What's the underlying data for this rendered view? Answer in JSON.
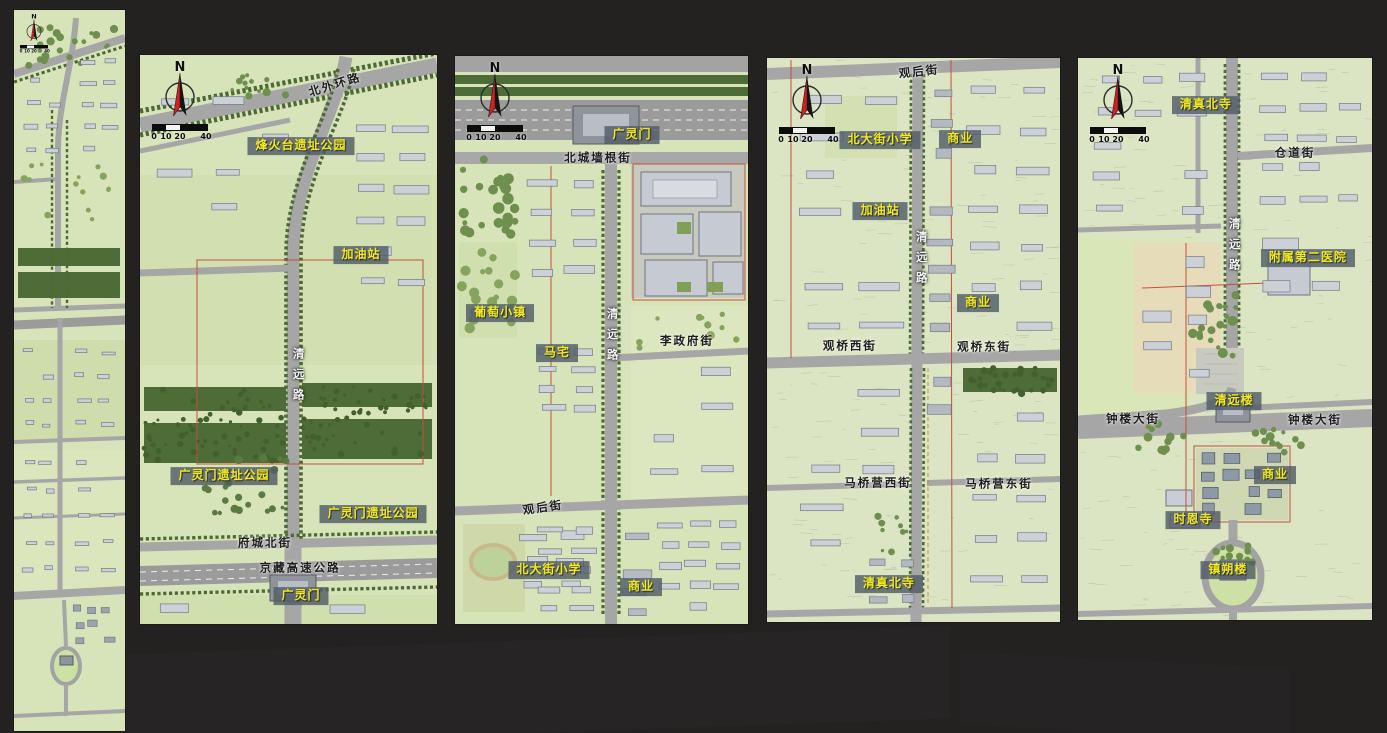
{
  "shared": {
    "compass_letter": "N",
    "scalebar_ticks": [
      "0",
      "10",
      "20",
      "40"
    ],
    "colors": {
      "place_text": "#f2ea1c",
      "place_box": "rgba(82,93,104,0.82)",
      "map_green": "#d7e3b8",
      "road_gray": "#a6a6a6",
      "tree_green": "#4d6c38",
      "backdrop": "#232221"
    }
  },
  "panels": [
    {
      "id": "overview",
      "labels": []
    },
    {
      "id": "section-1",
      "labels": [
        {
          "text": "北外环路",
          "kind": "street-dark",
          "x": 65.7,
          "y": 5.3,
          "rot": -17
        },
        {
          "text": "烽火台遗址公园",
          "kind": "place",
          "x": 54.2,
          "y": 16.0
        },
        {
          "text": "加油站",
          "kind": "place",
          "x": 74.4,
          "y": 35.1
        },
        {
          "text": "清远路",
          "kind": "street-light",
          "x": 53.2,
          "y": 56.8,
          "vertical": true
        },
        {
          "text": "广灵门遗址公园",
          "kind": "place",
          "x": 28.3,
          "y": 74.0
        },
        {
          "text": "广灵门遗址公园",
          "kind": "place",
          "x": 78.5,
          "y": 80.7
        },
        {
          "text": "府城北街",
          "kind": "street-dark",
          "x": 42.1,
          "y": 85.8
        },
        {
          "text": "京藏高速公路",
          "kind": "street-dark",
          "x": 53.9,
          "y": 90.2
        },
        {
          "text": "广灵门",
          "kind": "place",
          "x": 54.2,
          "y": 95.1
        }
      ]
    },
    {
      "id": "section-2",
      "labels": [
        {
          "text": "广灵门",
          "kind": "place",
          "x": 60.4,
          "y": 13.9
        },
        {
          "text": "北城墙根街",
          "kind": "street-dark",
          "x": 48.8,
          "y": 18.0
        },
        {
          "text": "葡萄小镇",
          "kind": "place",
          "x": 15.4,
          "y": 45.2
        },
        {
          "text": "马宅",
          "kind": "place",
          "x": 34.8,
          "y": 52.3
        },
        {
          "text": "清远路",
          "kind": "street-light",
          "x": 53.6,
          "y": 49.6,
          "vertical": true
        },
        {
          "text": "李政府街",
          "kind": "street-dark",
          "x": 79.2,
          "y": 50.2
        },
        {
          "text": "观后街",
          "kind": "street-dark",
          "x": 30.0,
          "y": 79.6,
          "rot": -8
        },
        {
          "text": "北大街小学",
          "kind": "place",
          "x": 32.1,
          "y": 90.5
        },
        {
          "text": "商业",
          "kind": "place",
          "x": 63.5,
          "y": 93.5
        }
      ]
    },
    {
      "id": "section-3",
      "labels": [
        {
          "text": "观后街",
          "kind": "street-dark",
          "x": 51.9,
          "y": 2.4,
          "rot": -6
        },
        {
          "text": "北大街小学",
          "kind": "place",
          "x": 38.6,
          "y": 14.5
        },
        {
          "text": "商业",
          "kind": "place",
          "x": 65.9,
          "y": 14.4
        },
        {
          "text": "加油站",
          "kind": "place",
          "x": 38.6,
          "y": 27.1
        },
        {
          "text": "清远路",
          "kind": "street-light",
          "x": 52.6,
          "y": 36.0,
          "vertical": true
        },
        {
          "text": "商业",
          "kind": "place",
          "x": 72.0,
          "y": 43.4
        },
        {
          "text": "观桥西街",
          "kind": "street-dark",
          "x": 28.3,
          "y": 51.1
        },
        {
          "text": "观桥东街",
          "kind": "street-dark",
          "x": 74.1,
          "y": 51.2
        },
        {
          "text": "马桥营西街",
          "kind": "street-dark",
          "x": 37.9,
          "y": 75.4
        },
        {
          "text": "马桥营东街",
          "kind": "street-dark",
          "x": 79.2,
          "y": 75.5
        },
        {
          "text": "清真北寺",
          "kind": "place",
          "x": 41.6,
          "y": 93.3
        }
      ]
    },
    {
      "id": "section-4",
      "labels": [
        {
          "text": "清真北寺",
          "kind": "place",
          "x": 43.5,
          "y": 8.4
        },
        {
          "text": "仓道街",
          "kind": "street-dark",
          "x": 73.8,
          "y": 16.9
        },
        {
          "text": "清远路",
          "kind": "street-light",
          "x": 53.1,
          "y": 33.8,
          "vertical": true
        },
        {
          "text": "附属第二医院",
          "kind": "place",
          "x": 78.2,
          "y": 35.6
        },
        {
          "text": "清远楼",
          "kind": "place",
          "x": 53.1,
          "y": 61.0
        },
        {
          "text": "钟楼大街",
          "kind": "street-dark",
          "x": 18.7,
          "y": 64.2
        },
        {
          "text": "钟楼大街",
          "kind": "street-dark",
          "x": 80.6,
          "y": 64.4
        },
        {
          "text": "商业",
          "kind": "place",
          "x": 67.0,
          "y": 74.2
        },
        {
          "text": "时恩寺",
          "kind": "place",
          "x": 39.1,
          "y": 82.2
        },
        {
          "text": "镇朔楼",
          "kind": "place",
          "x": 51.0,
          "y": 91.1
        }
      ]
    }
  ]
}
